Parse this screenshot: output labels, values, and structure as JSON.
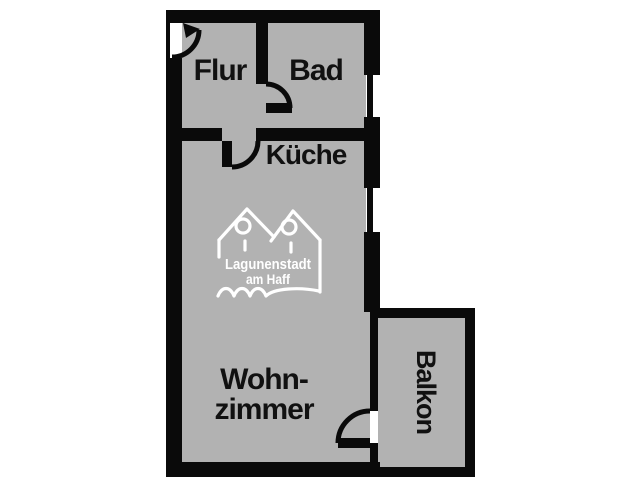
{
  "floorplan": {
    "title": "apartment-floor-plan",
    "colors": {
      "wall": "#0a0a0a",
      "floor": "#b2b2b2",
      "background": "#ffffff",
      "watermark": "#ffffff",
      "label_text": "#111111"
    },
    "rooms": {
      "flur": {
        "label": "Flur"
      },
      "bad": {
        "label": "Bad"
      },
      "kueche": {
        "label": "Küche"
      },
      "wohnzimmer": {
        "label_line1": "Wohn-",
        "label_line2": "zimmer"
      },
      "balkon": {
        "label": "Balkon"
      }
    },
    "watermark": {
      "line1": "Lagunenstadt",
      "line2": "am Haff"
    }
  }
}
